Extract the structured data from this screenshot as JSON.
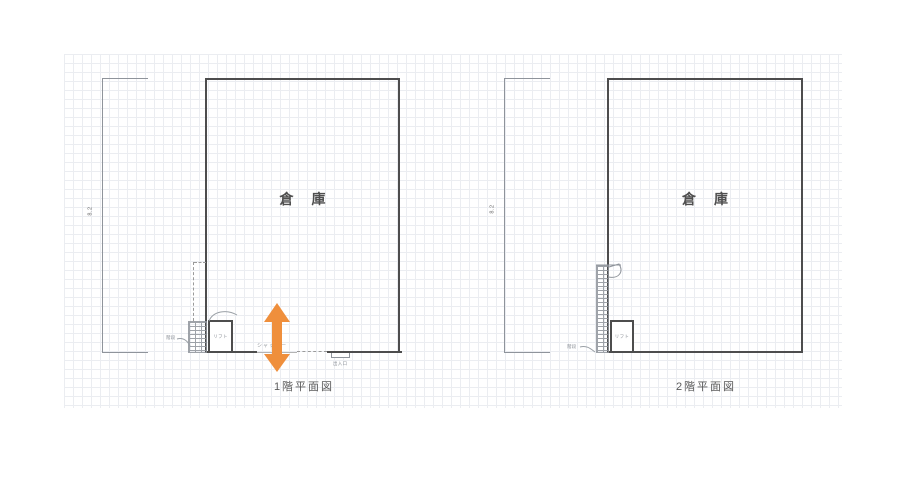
{
  "colors": {
    "wall": "#4d4d4d",
    "line": "#8f949b",
    "text": "#555555",
    "muted_text": "#8a8f96",
    "arrow": "#EF8F3C",
    "grid": "#ccd2dc"
  },
  "plans": {
    "first_floor": {
      "caption": "1階平面図",
      "room_label": "倉庫",
      "dimension_label": "8.2",
      "lift_label": "リフト",
      "stairs_label": "階段",
      "shutter_label": "シャッター",
      "door_label": "出入口"
    },
    "second_floor": {
      "caption": "2階平面図",
      "room_label": "倉庫",
      "dimension_label": "8.2",
      "lift_label": "リフト",
      "stairs_label": "階段"
    }
  }
}
